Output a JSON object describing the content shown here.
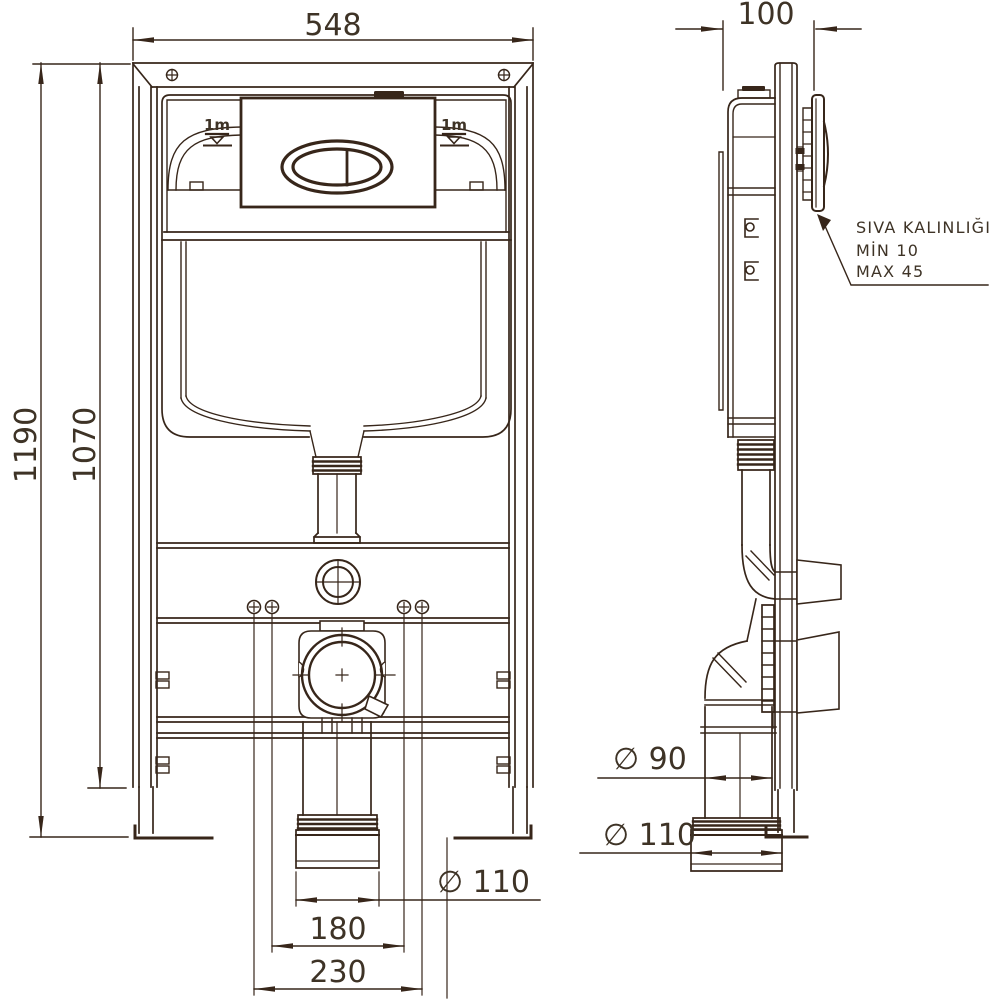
{
  "drawing": {
    "front": {
      "width": "548",
      "height_total": "1190",
      "height_frame": "1070",
      "outlet_diameter": "∅ 110",
      "fixing_spacing_inner": "180",
      "fixing_spacing_outer": "230",
      "level_mark_left": "1m",
      "level_mark_right": "1m"
    },
    "side": {
      "depth": "100",
      "flush_pipe_diameter": "∅ 90",
      "drain_pipe_diameter": "∅ 110",
      "plaster_note_line1": "SIVA KALINLIĞI",
      "plaster_note_line2": "MİN 10",
      "plaster_note_line3": "MAX 45"
    },
    "colors": {
      "ink": "#37261a",
      "background": "#ffffff"
    }
  }
}
